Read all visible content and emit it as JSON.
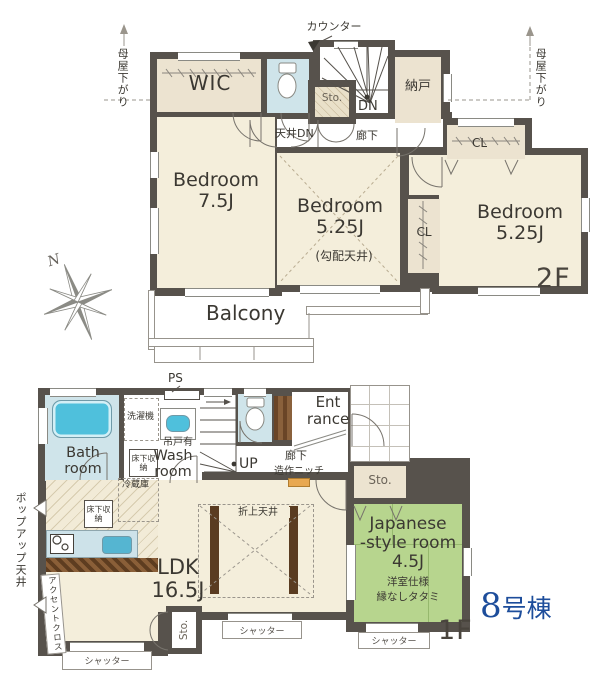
{
  "title": {
    "unit_number": "8",
    "unit_suffix": "号棟"
  },
  "compass": {
    "north": "N"
  },
  "floor2": {
    "label": "2F",
    "counter": "カウンター",
    "moya_sagari_left": "母屋下がり",
    "moya_sagari_right": "母屋下がり",
    "wic": "WIC",
    "toilet": "",
    "nando": "納戸",
    "storage": "Sto.",
    "down": "DN",
    "ceiling_down": "天井DN",
    "hallway": "廊下",
    "closet_top": "CL",
    "closet_mid": "CL",
    "bedroom1": {
      "name": "Bedroom",
      "size": "7.5J"
    },
    "bedroom2": {
      "name": "Bedroom",
      "size": "5.25J",
      "note": "(勾配天井)"
    },
    "bedroom3": {
      "name": "Bedroom",
      "size": "5.25J"
    },
    "balcony": "Balcony"
  },
  "floor1": {
    "label": "1F",
    "ps": "PS",
    "bath_room": "Bath room",
    "washer": "洗濯機",
    "hanging_cabinet": "吊戸有",
    "wash_room": "Wash room",
    "underfloor_storage_wash": "床下収納",
    "underfloor_storage_kitchen": "床下収納",
    "refrigerator": "冷蔵庫",
    "up": "UP",
    "entrance": "Ent rance",
    "hallway": "廊下",
    "niche": "造作ニッチ",
    "storage_entrance": "Sto.",
    "storage_living": "Sto.",
    "ldk": {
      "name": "LDK",
      "size": "16.5J"
    },
    "raised_ceiling": "折上天井",
    "japanese_room": {
      "line1": "Japanese",
      "line2": "-style room",
      "size": "4.5J",
      "note1": "洋室仕様",
      "note2": "縁なしタタミ"
    },
    "popup_ceiling": "ポップアップ天井",
    "accent_cloth": "アクセントクロス",
    "shutter_left": "シャッター",
    "shutter_middle": "シャッター",
    "shutter_right": "シャッター"
  },
  "colors": {
    "wall": "#57524c",
    "room_beige": "#f4eedb",
    "closet_beige": "#ece3d0",
    "wet_blue": "#cfe4ea",
    "tub_blue": "#4fc0dc",
    "tatami_green": "#b7d58e",
    "beam_brown": "#5a3c21",
    "niche_orange": "#e8a851",
    "unit_blue": "#1d4d9b"
  }
}
